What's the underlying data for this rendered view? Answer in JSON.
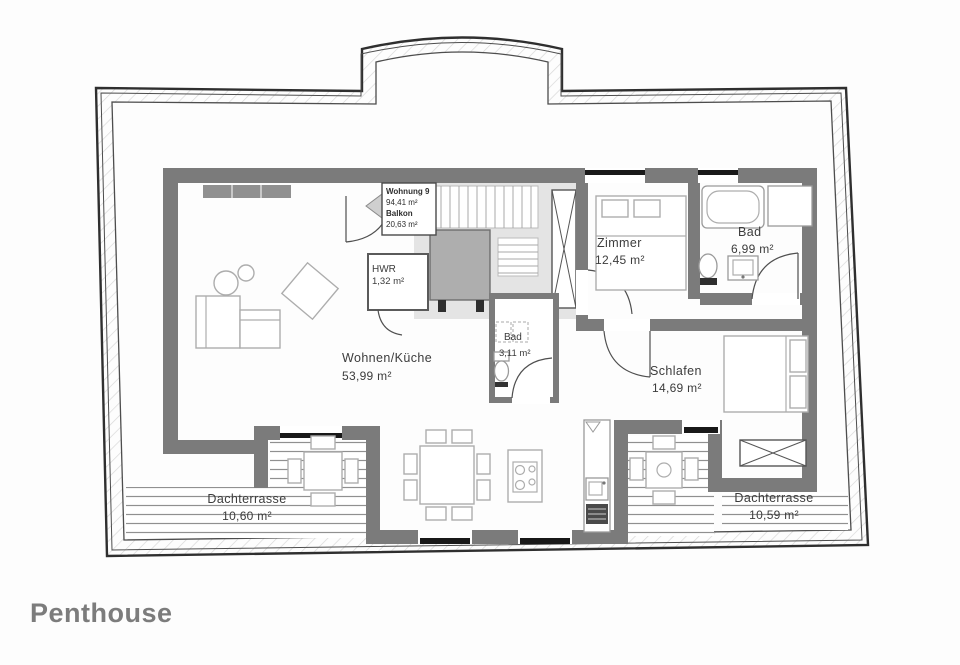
{
  "page": {
    "title": "Penthouse",
    "background": "#fdfdfd"
  },
  "unit_label": {
    "name": "Wohnung 9",
    "area": "94,41 m²",
    "balcony_label": "Balkon",
    "balcony_area": "20,63 m²"
  },
  "rooms": [
    {
      "id": "wohnen-kueche",
      "name": "Wohnen/Küche",
      "area": "53,99 m²"
    },
    {
      "id": "hwr",
      "name": "HWR",
      "area": "1,32 m²"
    },
    {
      "id": "bad-klein",
      "name": "Bad",
      "area": "3,11 m²"
    },
    {
      "id": "zimmer",
      "name": "Zimmer",
      "area": "12,45 m²"
    },
    {
      "id": "bad-gross",
      "name": "Bad",
      "area": "6,99 m²"
    },
    {
      "id": "schlafen",
      "name": "Schlafen",
      "area": "14,69 m²"
    },
    {
      "id": "dachterrasse-links",
      "name": "Dachterrasse",
      "area": "10,60 m²"
    },
    {
      "id": "dachterrasse-rechts",
      "name": "Dachterrasse",
      "area": "10,59 m²"
    }
  ],
  "colors": {
    "wall": "#7b7b7b",
    "window_bar": "#191919",
    "roof_line": "#2f2f2f",
    "hatch_line": "#d8d8d8",
    "deck_line": "#909090",
    "furniture_line": "#adadad",
    "core_background": "#e4e4e4",
    "elevator_fill": "#aeaeae",
    "label_text": "#3c3c3c",
    "title_text": "#7c7c7c"
  },
  "icons": {
    "entrance_arrow": "left-triangle"
  }
}
